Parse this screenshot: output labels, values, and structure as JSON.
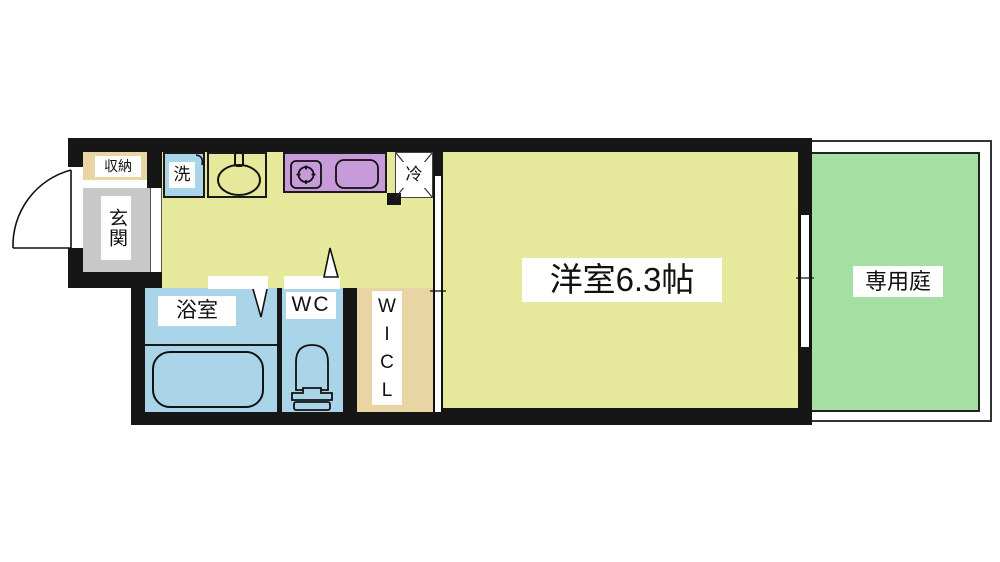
{
  "plan": {
    "rooms": {
      "storage": {
        "label": "収納"
      },
      "entrance": {
        "label": "玄関"
      },
      "washer": {
        "label": "洗"
      },
      "fridge": {
        "label": "冷"
      },
      "bathroom": {
        "label": "浴室"
      },
      "toilet": {
        "label": "WC"
      },
      "closet": {
        "label": "W\nI\nC\nL"
      },
      "main_room": {
        "label": "洋室6.3帖"
      },
      "garden": {
        "label": "専用庭"
      }
    },
    "colors": {
      "wall": "#161616",
      "floor": "#e6e99c",
      "water": "#aad4e8",
      "kitchen": "#c79bd9",
      "wood": "#e9d4a4",
      "genkan": "#c8c8c8",
      "garden": "#a6dfa4",
      "line": "#111111"
    }
  }
}
